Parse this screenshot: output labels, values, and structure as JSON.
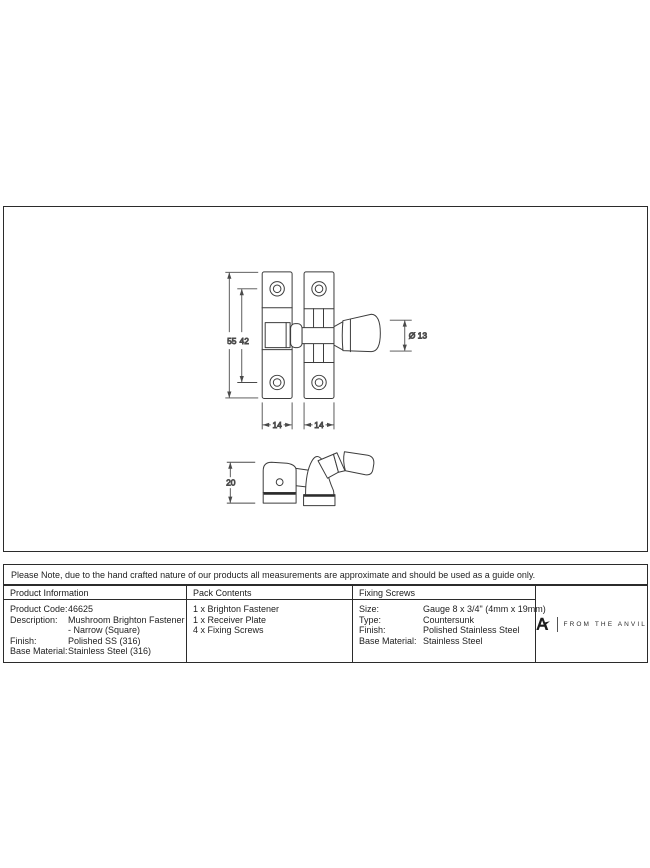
{
  "brand": {
    "name": "FROM THE ANVIL"
  },
  "note": "Please Note, due to the hand crafted nature of our products all measurements are approximate and should be used as a guide only.",
  "drawing": {
    "dims": {
      "plate_height": "55",
      "hole_spacing": "42",
      "left_plate_width": "14",
      "right_plate_width": "14",
      "knob_diameter": "Ø 13",
      "side_height": "20"
    }
  },
  "table": {
    "product_info": {
      "header": "Product Information",
      "rows": [
        {
          "label": "Product Code:",
          "value": "46625"
        },
        {
          "label": "Description:",
          "value": "Mushroom Brighton Fastener"
        },
        {
          "label": "",
          "value": "- Narrow (Square)"
        },
        {
          "label": "Finish:",
          "value": "Polished SS (316)"
        },
        {
          "label": "Base Material:",
          "value": "Stainless Steel (316)"
        }
      ]
    },
    "pack_contents": {
      "header": "Pack Contents",
      "items": [
        "1 x Brighton Fastener",
        "1 x Receiver Plate",
        "4 x Fixing Screws"
      ]
    },
    "fixing_screws": {
      "header": "Fixing Screws",
      "rows": [
        {
          "label": "Size:",
          "value": "Gauge 8 x 3/4\" (4mm x 19mm)"
        },
        {
          "label": "Type:",
          "value": "Countersunk"
        },
        {
          "label": "Finish:",
          "value": "Polished Stainless Steel"
        },
        {
          "label": "Base Material:",
          "value": "Stainless Steel"
        }
      ]
    }
  }
}
